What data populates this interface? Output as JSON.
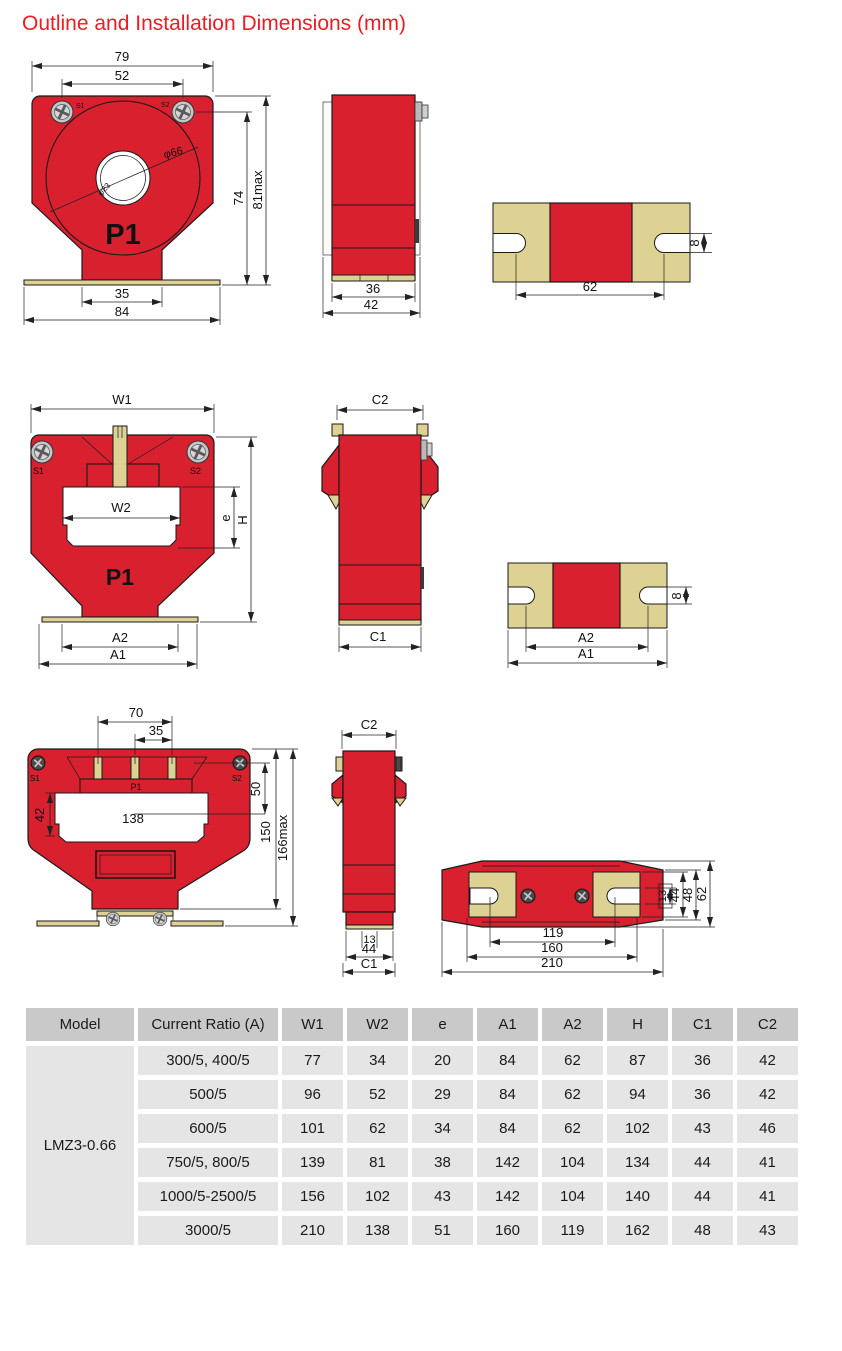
{
  "title": "Outline and Installation Dimensions (mm)",
  "colors": {
    "body_red": "#d8202f",
    "mount_tan": "#ddd193",
    "title_red": "#ec1c24",
    "outline": "#1a1a1a",
    "table_header_bg": "#c9c9c9",
    "table_cell_bg": "#e5e5e5"
  },
  "drawings": {
    "small_front": {
      "w79": "79",
      "w52": "52",
      "s1": "S1",
      "s2": "S2",
      "phi66": "φ66",
      "phi23": "φ23",
      "p1": "P1",
      "h74": "74",
      "h81": "81max",
      "w35": "35",
      "w84": "84"
    },
    "small_side": {
      "w36": "36",
      "w42": "42"
    },
    "small_bottom": {
      "span62": "62",
      "slot8": "8"
    },
    "medium_front": {
      "w1": "W1",
      "s1": "S1",
      "s2": "S2",
      "w2": "W2",
      "e": "e",
      "h": "H",
      "p1": "P1",
      "a2": "A2",
      "a1": "A1"
    },
    "medium_side": {
      "c2": "C2",
      "c1": "C1"
    },
    "medium_bottom": {
      "a2": "A2",
      "a1": "A1",
      "slot8": "8"
    },
    "large_front": {
      "t70": "70",
      "t35": "35",
      "s1": "S1",
      "s2": "S2",
      "p1": "P1",
      "r50": "50",
      "l42": "42",
      "w138": "138",
      "h150": "150",
      "h166": "166max"
    },
    "large_side": {
      "c2": "C2",
      "b13": "13",
      "b44": "44",
      "c1": "C1"
    },
    "large_bottom": {
      "b119": "119",
      "b160": "160",
      "b210": "210",
      "r13": "13",
      "r44": "44",
      "r48": "48",
      "r62": "62"
    }
  },
  "table": {
    "headers": [
      "Model",
      "Current Ratio (A)",
      "W1",
      "W2",
      "e",
      "A1",
      "A2",
      "H",
      "C1",
      "C2"
    ],
    "model": "LMZ3-0.66",
    "rows": [
      {
        "ratio": "300/5, 400/5",
        "values": [
          "77",
          "34",
          "20",
          "84",
          "62",
          "87",
          "36",
          "42"
        ]
      },
      {
        "ratio": "500/5",
        "values": [
          "96",
          "52",
          "29",
          "84",
          "62",
          "94",
          "36",
          "42"
        ]
      },
      {
        "ratio": "600/5",
        "values": [
          "101",
          "62",
          "34",
          "84",
          "62",
          "102",
          "43",
          "46"
        ]
      },
      {
        "ratio": "750/5, 800/5",
        "values": [
          "139",
          "81",
          "38",
          "142",
          "104",
          "134",
          "44",
          "41"
        ]
      },
      {
        "ratio": "1000/5-2500/5",
        "values": [
          "156",
          "102",
          "43",
          "142",
          "104",
          "140",
          "44",
          "41"
        ]
      },
      {
        "ratio": "3000/5",
        "values": [
          "210",
          "138",
          "51",
          "160",
          "119",
          "162",
          "48",
          "43"
        ]
      }
    ]
  }
}
